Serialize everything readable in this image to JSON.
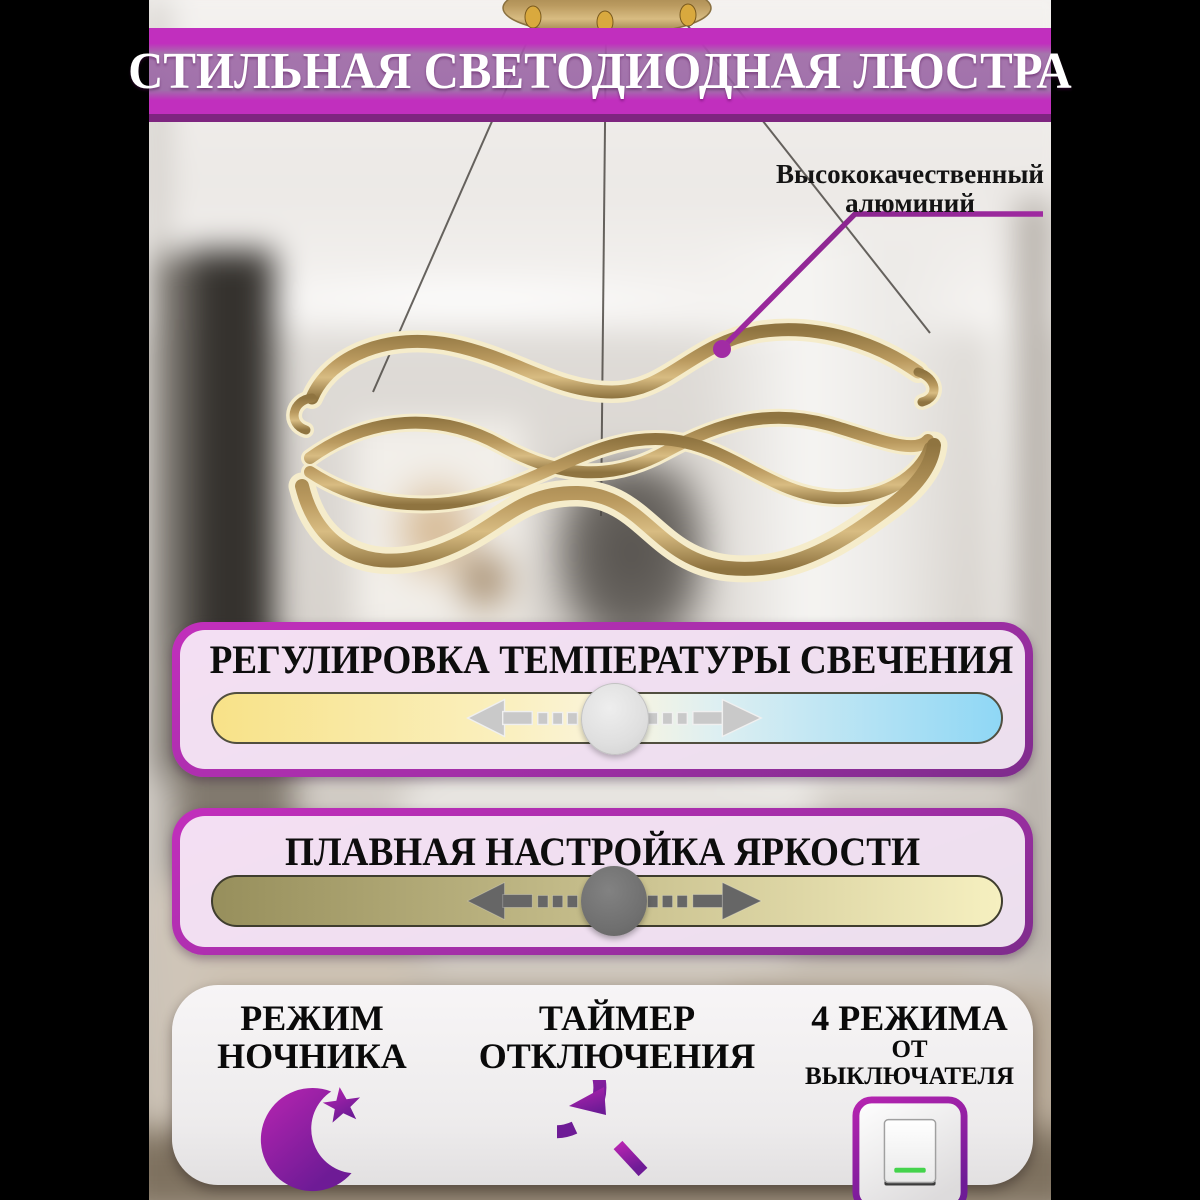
{
  "banner": {
    "title": "СТИЛЬНАЯ СВЕТОДИОДНАЯ ЛЮСТРА"
  },
  "callout": {
    "line1": "Высококачественный",
    "line2": "алюминий",
    "target": "chandelier-frame"
  },
  "panels": {
    "temperature": {
      "title": "РЕГУЛИРОВКА ТЕМПЕРАТУРЫ СВЕЧЕНИЯ"
    },
    "brightness": {
      "title": "ПЛАВНАЯ НАСТРОЙКА ЯРКОСТИ"
    }
  },
  "features": [
    {
      "line1": "РЕЖИМ",
      "line2": "НОЧНИКА",
      "icon": "crescent-moon-star-icon"
    },
    {
      "line1": "ТАЙМЕР",
      "line2": "ОТКЛЮЧЕНИЯ",
      "icon": "timer-clock-icon"
    },
    {
      "line1": "4 РЕЖИМА",
      "line2": "ОТ ВЫКЛЮЧАТЕЛЯ",
      "icon": "wall-switch-icon"
    }
  ],
  "colors": {
    "banner-magenta": "#C12FBE",
    "banner-underline": "#7E2580",
    "panel-border-top": "#C22FBC",
    "panel-border-bottom": "#7E2C8C",
    "temp-warm": "#F8E288",
    "temp-mid": "#FAF5E0",
    "temp-cool": "#8FD7F5",
    "temp-knob": "#DFDFDF",
    "temp-arrow": "#C9C9C9",
    "bright-dark": "#978F5C",
    "bright-mid": "#CCC492",
    "bright-light": "#F6F0C0",
    "bright-knob": "#6F6F6F",
    "bright-arrow": "#666666",
    "switch-green": "#44D34C",
    "gold": "#BA9A5F",
    "gold-dark": "#8F7440",
    "led-cream": "#F5ECCB",
    "callout-line": "#A12CA4",
    "icon-magenta": "#B524B0",
    "icon-purple": "#6E1B96"
  }
}
